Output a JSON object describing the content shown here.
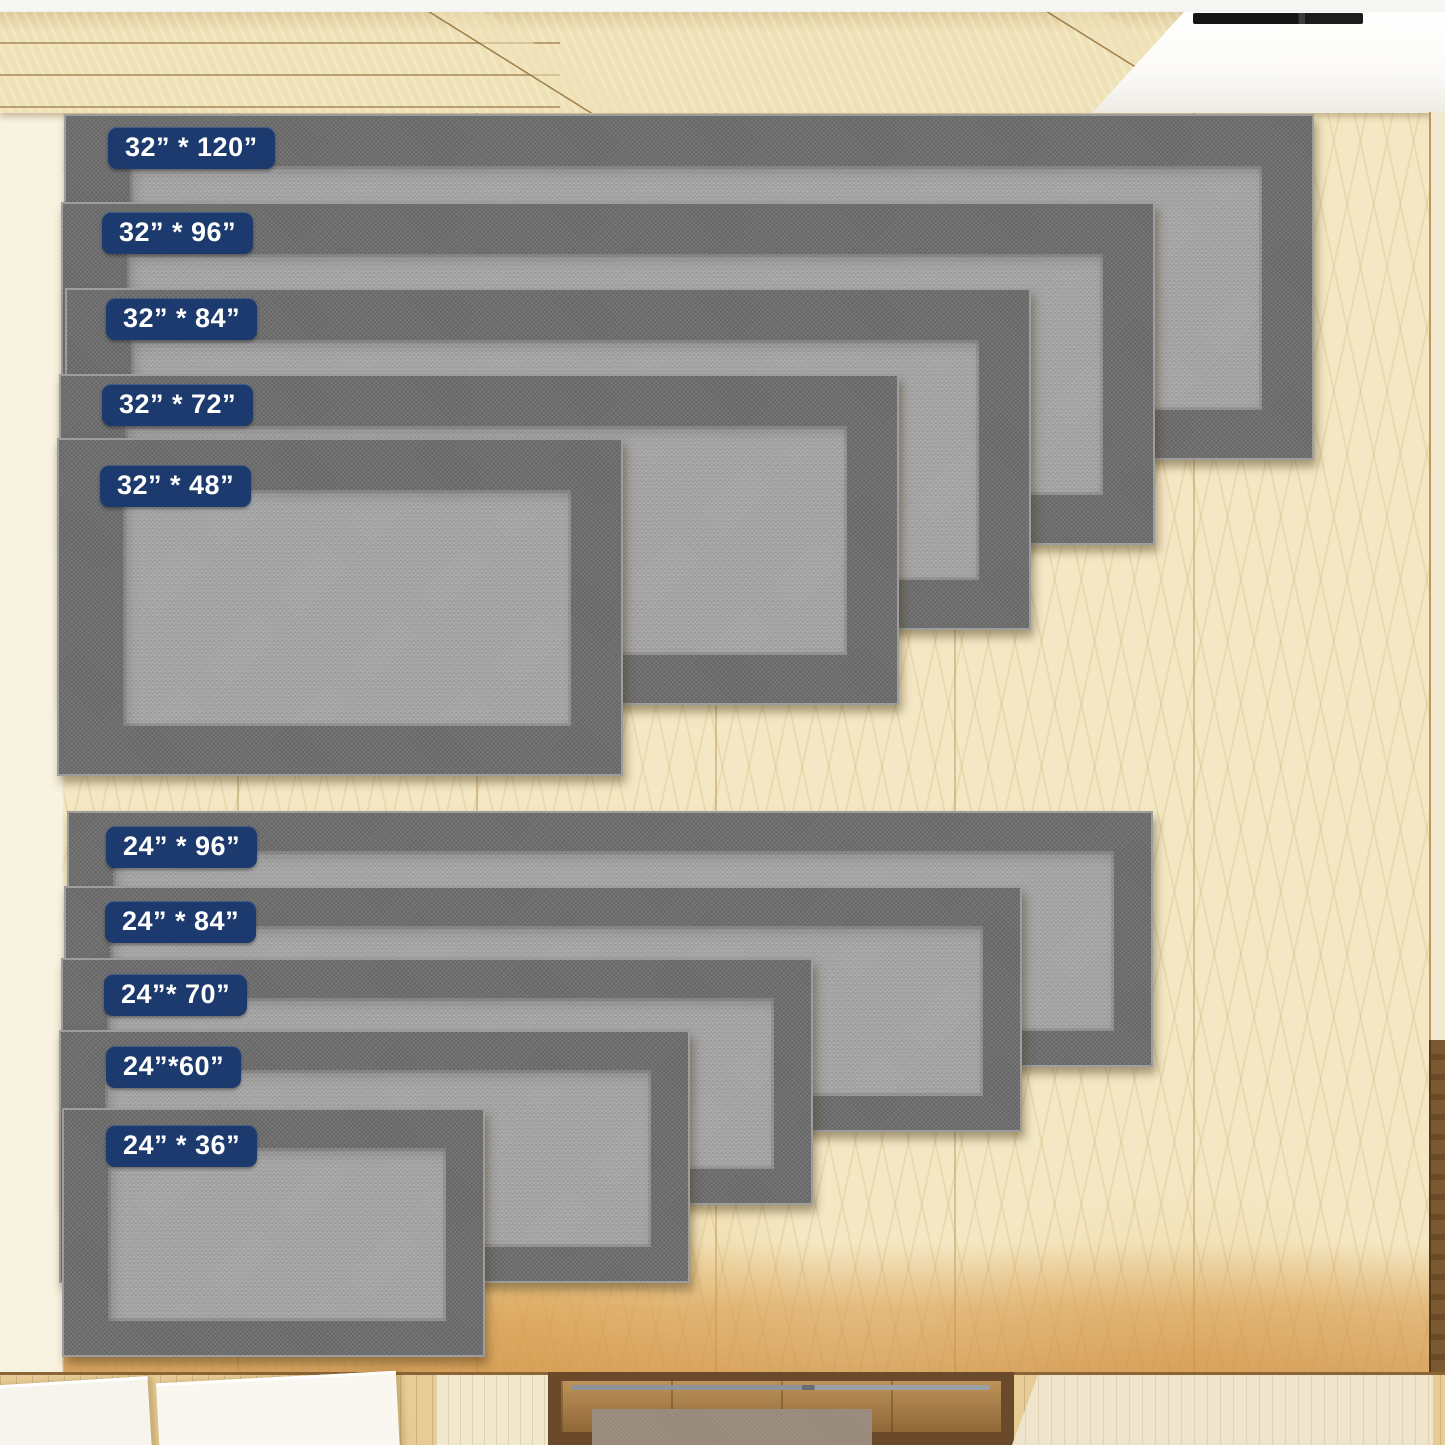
{
  "groups": [
    {
      "name": "32-inch-wide",
      "rugs": [
        {
          "label": "32” * 120”"
        },
        {
          "label": "32” * 96”"
        },
        {
          "label": "32” * 84”"
        },
        {
          "label": "32” * 72”"
        },
        {
          "label": "32” * 48”"
        }
      ]
    },
    {
      "name": "24-inch-wide",
      "rugs": [
        {
          "label": "24” * 96”"
        },
        {
          "label": "24” * 84”"
        },
        {
          "label": "24”* 70”"
        },
        {
          "label": "24”*60”"
        },
        {
          "label": "24” * 36”"
        }
      ]
    }
  ],
  "colors": {
    "badge_background": "#1c3a6d",
    "badge_text": "#ffffff",
    "rug_border_gray": "#6f6f6f",
    "rug_center_gray": "#a3a3a3",
    "rug_binding_gray": "#9d9d9d",
    "floor_pale_wood": "#f4e8c4",
    "floor_warm_wood": "#d9964a",
    "cabinet_wood": "#efe1b6",
    "appliance_white": "#fbfaf7",
    "vent_black": "#151515",
    "frame_dark_wood": "#6a4a2a",
    "inner_mat_taupe": "#97897a",
    "white_slab": "#f7f4ed"
  }
}
